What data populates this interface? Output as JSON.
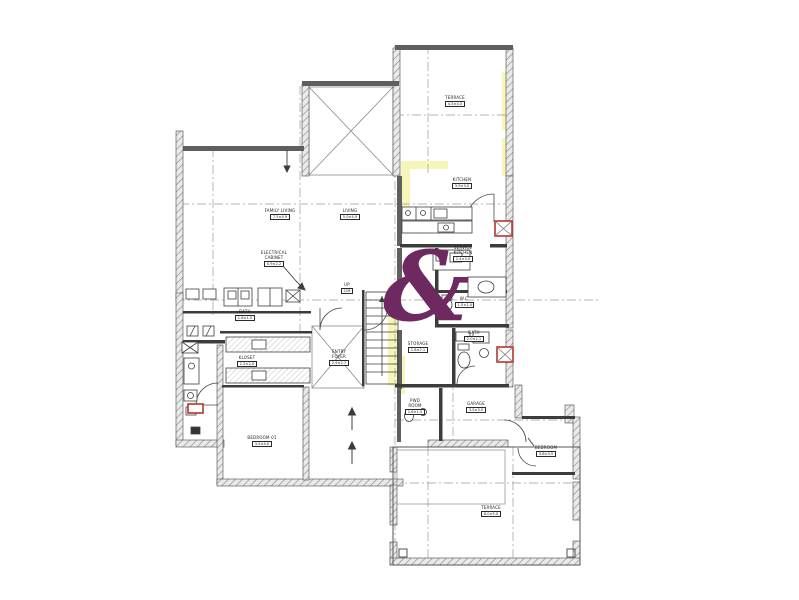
{
  "watermark": {
    "glyph": "&",
    "color": "#6e2a60"
  },
  "accents": {
    "highlight_color": "#f4f4a2",
    "marker_red": "#b5352f",
    "wall_dark": "#5f5f5f",
    "line_grey": "#9a9a9a"
  },
  "rooms": [
    {
      "name": "FAMILY LIVING",
      "dims": "7.5×4.9"
    },
    {
      "name": "LIVING",
      "dims": "5.0×4.9"
    },
    {
      "name": "TERRACE",
      "dims": "4.5×4.0"
    },
    {
      "name": "KITCHEN",
      "dims": "3.9×3.0"
    },
    {
      "name": "SERVICE KITCHEN",
      "dims": "2.4×3.0"
    },
    {
      "name": "W.C",
      "dims": "1.5×1.4"
    },
    {
      "name": "BATH",
      "dims": "2.0×2.1"
    },
    {
      "name": "STORAGE",
      "dims": "1.6×2.1"
    },
    {
      "name": "PWD ROOM",
      "dims": "1.6×1.5"
    },
    {
      "name": "GARAGE",
      "dims": "3.5×3.0"
    },
    {
      "name": "BEDROOM",
      "dims": "3.6×3.5"
    },
    {
      "name": "TERRACE",
      "dims": "6.0×5.0"
    },
    {
      "name": "BEDROOM 01",
      "dims": "3.5×4.0"
    },
    {
      "name": "KLOSET",
      "dims": "2.5×2.0"
    },
    {
      "name": "ENTRY FOYER",
      "dims": "2.9×2.7"
    },
    {
      "name": "BATH",
      "dims": "1.8×1.5"
    },
    {
      "name": "ELECTRICAL CABINET",
      "dims": "0.9×2.2"
    },
    {
      "name": "UP",
      "dims": "21R"
    }
  ]
}
